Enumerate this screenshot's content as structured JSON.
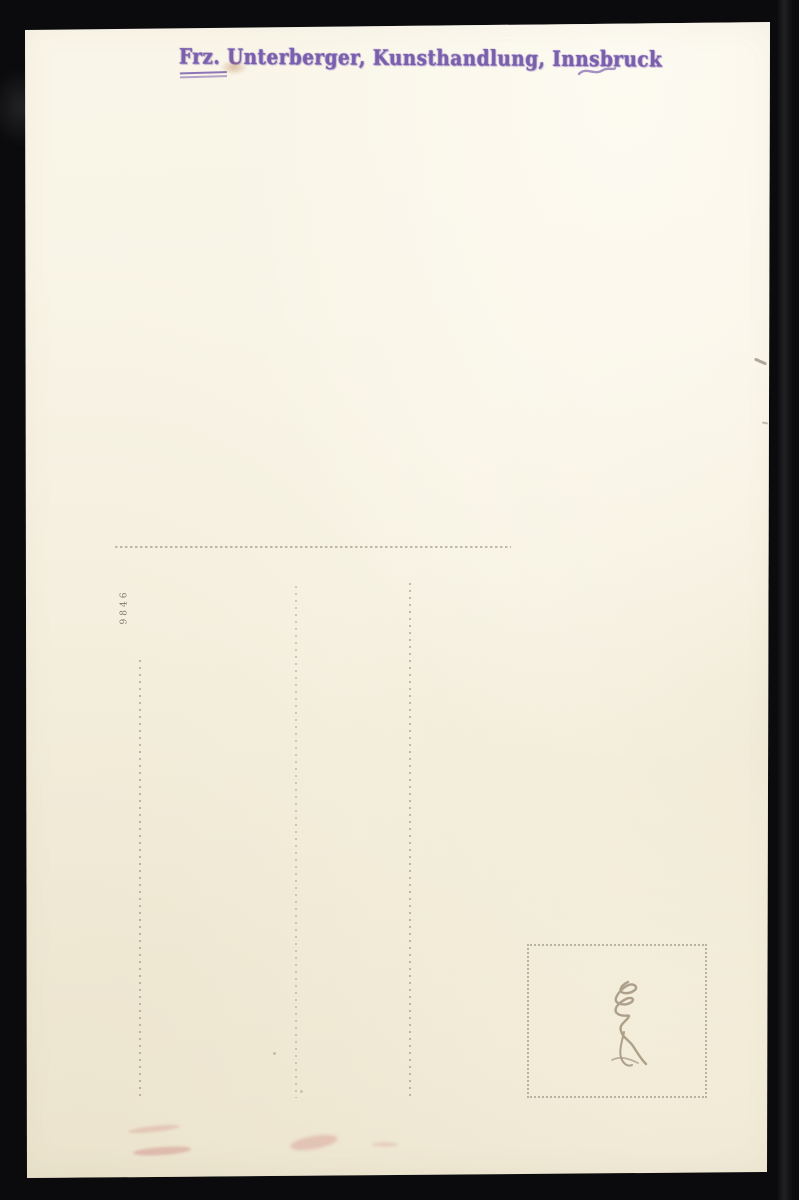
{
  "postcard_back": {
    "publisher_stamp": {
      "text": "Frz. Unterberger, Kunsthandlung, Innsbruck",
      "ink_color": "#7a5fae"
    },
    "serial_number": "9846",
    "colors": {
      "paper": "#f8f4e5",
      "photo_background": "#0b0b0d",
      "ruled_dots": "#68624f",
      "pencil": "#8d7c64",
      "red_smudge": "#c97a7a"
    }
  }
}
